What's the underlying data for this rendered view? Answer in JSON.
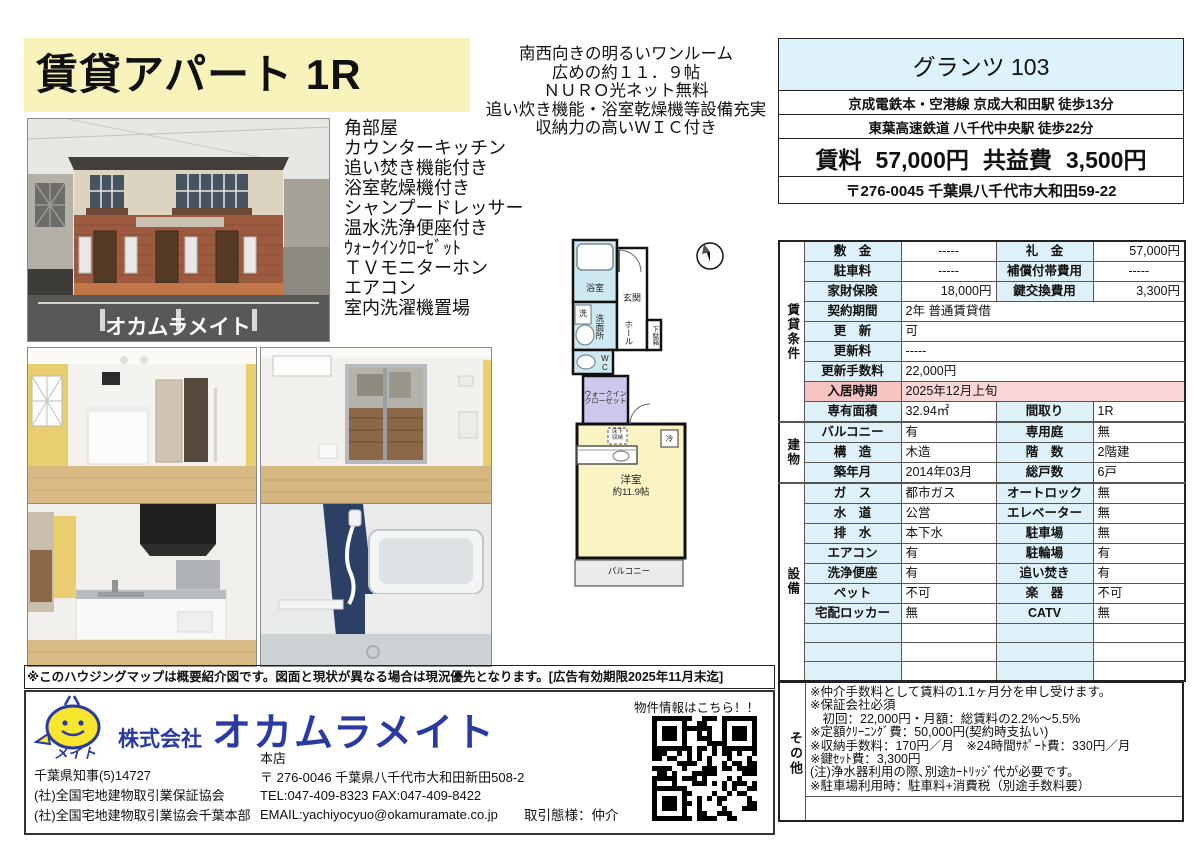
{
  "page": {
    "title": "賃貸アパート 1R",
    "catchcopy": {
      "0": "南西向きの明るいワンルーム",
      "1": "広めの約１１．９帖",
      "2": "ＮＵＲＯ光ネット無料",
      "3": "追い炊き機能・浴室乾燥機等設備充実",
      "4": "収納力の高いＷＩＣ付き"
    },
    "features": {
      "0": "角部屋",
      "1": "カウンターキッチン",
      "2": "追い焚き機能付き",
      "3": "浴室乾燥機付き",
      "4": "シャンプードレッサー",
      "5": "温水洗浄便座付き",
      "6": "ｳｫｰｸｲﾝｸﾛｰｾﾞｯﾄ",
      "7": "ＴＶモニターホン",
      "8": "エアコン",
      "9": "室内洗濯機置場"
    },
    "disclaimer": "※このハウジングマップは概要紹介図です。図面と現状が異なる場合は現況優先となります。[広告有効期限2025年11月末迄]"
  },
  "property": {
    "name": "グランツ 103",
    "access1": "京成電鉄本・空港線 京成大和田駅 徒歩13分",
    "access2": "東葉高速鉄道 八千代中央駅 徒歩22分",
    "rent_label": "賃料",
    "rent": "57,000円",
    "fee_label": "共益費",
    "fee": "3,500円",
    "address": "〒276-0045 千葉県八千代市大和田59-22"
  },
  "t": {
    "sections": {
      "rental": "賃貸条件",
      "building": "建物",
      "facility": "設備",
      "other": "その他"
    },
    "r0": {
      "a": "敷　金",
      "b": "-----",
      "c": "礼　金",
      "d": "57,000円"
    },
    "r1": {
      "a": "駐車料",
      "b": "-----",
      "c": "補償付帯費用",
      "d": "-----"
    },
    "r2": {
      "a": "家財保険",
      "b": "18,000円",
      "c": "鍵交換費用",
      "d": "3,300円"
    },
    "r3": {
      "a": "契約期間",
      "b": "2年 普通賃貸借"
    },
    "r4": {
      "a": "更　新",
      "b": "可"
    },
    "r5": {
      "a": "更新料",
      "b": "-----"
    },
    "r6": {
      "a": "更新手数料",
      "b": "22,000円"
    },
    "r7": {
      "a": "入居時期",
      "b": "2025年12月上旬"
    },
    "r8": {
      "a": "専有面積",
      "b": "32.94㎡",
      "c": "間取り",
      "d": "1R"
    },
    "r9": {
      "a": "バルコニー",
      "b": "有",
      "c": "専用庭",
      "d": "無"
    },
    "r10": {
      "a": "構　造",
      "b": "木造",
      "c": "階　数",
      "d": "2階建"
    },
    "r11": {
      "a": "築年月",
      "b": "2014年03月",
      "c": "総戸数",
      "d": "6戸"
    },
    "r12": {
      "a": "ガ　ス",
      "b": "都市ガス",
      "c": "オートロック",
      "d": "無"
    },
    "r13": {
      "a": "水　道",
      "b": "公営",
      "c": "エレベーター",
      "d": "無"
    },
    "r14": {
      "a": "排　水",
      "b": "本下水",
      "c": "駐車場",
      "d": "無"
    },
    "r15": {
      "a": "エアコン",
      "b": "有",
      "c": "駐輪場",
      "d": "有"
    },
    "r16": {
      "a": "洗浄便座",
      "b": "有",
      "c": "追い焚き",
      "d": "有"
    },
    "r17": {
      "a": "ペット",
      "b": "不可",
      "c": "楽　器",
      "d": "不可"
    },
    "r18": {
      "a": "宅配ロッカー",
      "b": "無",
      "c": "CATV",
      "d": "無"
    }
  },
  "notes": {
    "0": "※仲介手数料として賃料の1.1ヶ月分を申し受けます。",
    "1": "※保証会社必須",
    "2": "　初回：22,000円・月額：総賃料の2.2%～5.5%",
    "3": "※定額ｸﾘｰﾆﾝｸﾞ費：50,000円(契約時支払い)",
    "4": "※収納手数料：170円／月　※24時間ｻﾎﾟｰﾄ費：330円／月",
    "5": "※鍵ｾｯﾄ費：3,300円",
    "6": "(注)浄水器利用の際､別途ｶｰﾄﾘｯｼﾞ代が必要です。",
    "7": "※駐車場利用時：駐車料+消費税（別途手数料要）"
  },
  "floorplan": {
    "bath": "浴室",
    "washer": "洗",
    "washroom": "洗面所",
    "wc": "WC",
    "entrance": "玄関",
    "hall": "ホール",
    "shoebox": "下駄箱",
    "wic1": "ウォークイン",
    "wic2": "クローゼット",
    "room": "洋室",
    "room_size": "約11.9帖",
    "fridge": "冷",
    "underfloor1": "床下",
    "underfloor2": "収納",
    "balcony": "バルコニー",
    "compass": "N"
  },
  "photos": {
    "watermark": "オカムラメイト"
  },
  "company": {
    "prefix": "株式会社",
    "name": "オカムラメイト",
    "logo_text": "メイト",
    "license1": "千葉県知事(5)14727",
    "license2": "(社)全国宅地建物取引業保証協会",
    "license3": "(社)全国宅地建物取引業協会千葉本部",
    "office_label": "本店",
    "office_addr": "〒 276-0046 千葉県八千代市大和田新田508-2",
    "office_tel": "TEL:047-409-8323 FAX:047-409-8422",
    "office_email": "EMAIL:yachiyocyuo@okamuramate.co.jp",
    "qr_label": "物件情報はこちら！！",
    "deal_type": "取引態様：仲介"
  }
}
